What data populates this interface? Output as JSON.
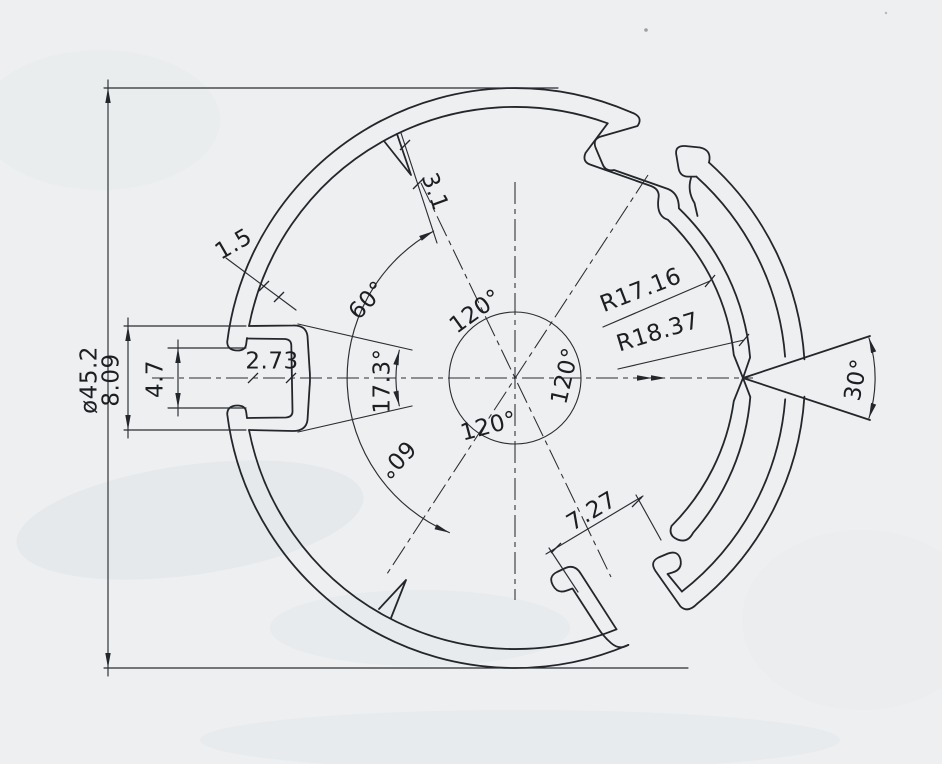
{
  "document": {
    "kind": "scanned technical section drawing of a circular extrusion profile",
    "background_color": "#edeff1",
    "line_color": "#23262a"
  },
  "dims": {
    "overall_diameter": "ø45.2",
    "left_slot_height": "8.09",
    "left_slot_opening": "4.7",
    "left_slot_depth": "2.73",
    "wall_thickness": "1.5",
    "rib_length": "3.1",
    "radius_inner": "R17.16",
    "radius_outer": "R18.37",
    "notch_angle": "30°",
    "angle_upper": "60°",
    "angle_middle": "17.3°",
    "angle_lower": "60°",
    "angle_120_top": "120°",
    "angle_120_right": "120°",
    "angle_120_bottom": "120°",
    "bottom_slot_width": "7.27"
  }
}
